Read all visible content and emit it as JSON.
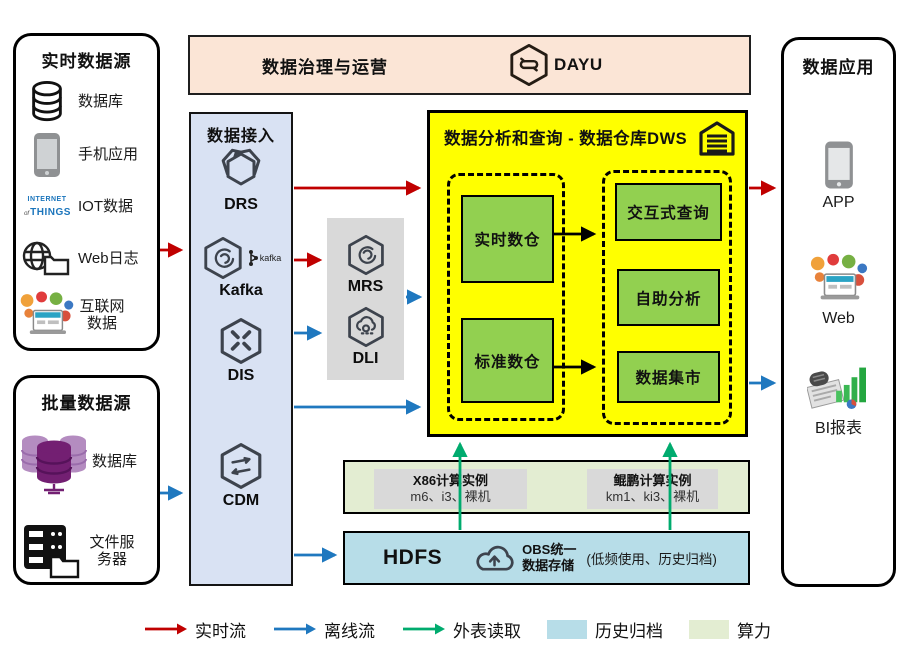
{
  "palette": {
    "realtime_flow": "#c00000",
    "offline_flow": "#1f78bf",
    "external_read": "#00ab6e",
    "history_archive": "#b7dde8",
    "compute_power": "#e3edd2",
    "warehouse_bg": "#ffff00",
    "module_green": "#92d050",
    "ingestion_bg": "#d9e2f3",
    "governance_bg": "#fbe5d6",
    "panel_gray": "#d9d9d9"
  },
  "governance": {
    "title": "数据治理与运营",
    "product": "DAYU"
  },
  "realtime_sources": {
    "title": "实时数据源",
    "items": [
      {
        "label": "数据库",
        "icon": "database-icon"
      },
      {
        "label": "手机应用",
        "icon": "mobile-phone-icon"
      },
      {
        "label": "IOT数据",
        "icon": "iot-wordcloud-icon"
      },
      {
        "label": "Web日志",
        "icon": "web-log-icon"
      },
      {
        "label": "互联网数据",
        "icon": "internet-collage-icon"
      }
    ],
    "iot_icon_text": {
      "line1": "INTERNET",
      "mid": "of",
      "line2": "THINGS"
    }
  },
  "batch_sources": {
    "title": "批量数据源",
    "items": [
      {
        "label": "数据库",
        "icon": "database-cluster-icon"
      },
      {
        "label": "文件服务器",
        "icon": "file-server-icon"
      }
    ]
  },
  "ingestion": {
    "title": "数据接入",
    "services": [
      {
        "label": "DRS"
      },
      {
        "label": "Kafka",
        "badge": "kafka"
      },
      {
        "label": "DIS"
      },
      {
        "label": "CDM"
      }
    ]
  },
  "processing": {
    "services": [
      {
        "label": "MRS"
      },
      {
        "label": "DLI"
      }
    ]
  },
  "warehouse": {
    "title": "数据分析和查询 - 数据仓库DWS",
    "storage_modules": [
      "实时数仓",
      "标准数仓"
    ],
    "analysis_modules": [
      "交互式查询",
      "自助分析",
      "数据集市"
    ]
  },
  "compute": {
    "instances": [
      {
        "title": "X86计算实例",
        "specs": "m6、i3、裸机"
      },
      {
        "title": "鲲鹏计算实例",
        "specs": "km1、ki3、裸机"
      }
    ]
  },
  "storage": {
    "hdfs": "HDFS",
    "obs_line1": "OBS统一",
    "obs_line2": "数据存储",
    "note": "(低频使用、历史归档)"
  },
  "applications": {
    "title": "数据应用",
    "items": [
      {
        "label": "APP",
        "icon": "app-phone-icon"
      },
      {
        "label": "Web",
        "icon": "web-collage-icon"
      },
      {
        "label": "BI报表",
        "icon": "bi-report-icon"
      }
    ]
  },
  "legend": {
    "items": [
      {
        "label": "实时流",
        "type": "arrow",
        "color": "#c00000"
      },
      {
        "label": "离线流",
        "type": "arrow",
        "color": "#1f78bf"
      },
      {
        "label": "外表读取",
        "type": "arrow",
        "color": "#00ab6e"
      },
      {
        "label": "历史归档",
        "type": "swatch",
        "color": "#b7dde8"
      },
      {
        "label": "算力",
        "type": "swatch",
        "color": "#e3edd2"
      }
    ]
  }
}
